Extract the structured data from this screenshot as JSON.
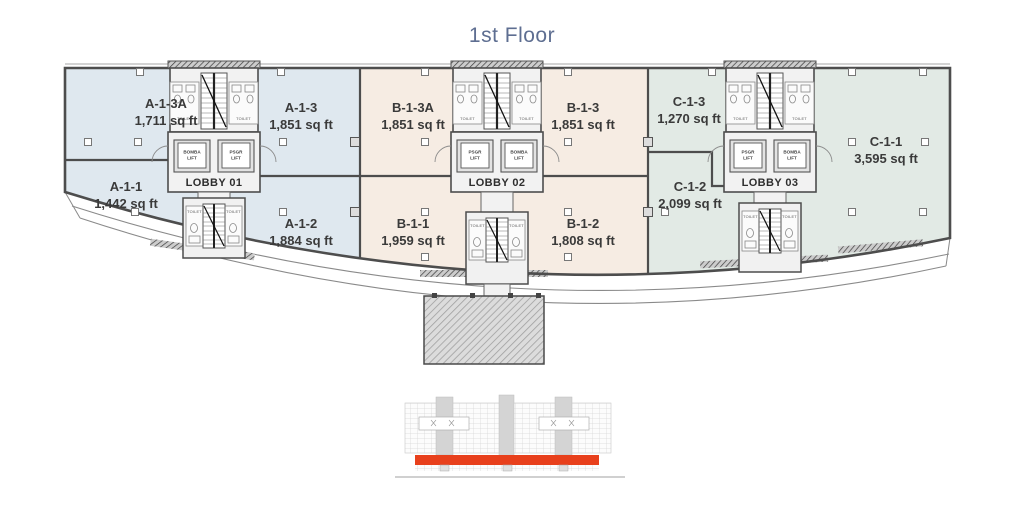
{
  "title": "1st Floor",
  "plan": {
    "units": [
      {
        "id": "A-1-3A",
        "area": "1,711 sq ft"
      },
      {
        "id": "A-1-3",
        "area": "1,851 sq ft"
      },
      {
        "id": "A-1-1",
        "area": "1,442 sq ft"
      },
      {
        "id": "A-1-2",
        "area": "1,884 sq ft"
      },
      {
        "id": "B-1-3A",
        "area": "1,851 sq ft"
      },
      {
        "id": "B-1-3",
        "area": "1,851 sq ft"
      },
      {
        "id": "B-1-1",
        "area": "1,959 sq ft"
      },
      {
        "id": "B-1-2",
        "area": "1,808 sq ft"
      },
      {
        "id": "C-1-3",
        "area": "1,270 sq ft"
      },
      {
        "id": "C-1-2",
        "area": "2,099 sq ft"
      },
      {
        "id": "C-1-1",
        "area": "3,595 sq ft"
      }
    ],
    "lobbies": [
      {
        "name": "LOBBY 01",
        "lifts": [
          {
            "line1": "BOMBA",
            "line2": "LIFT"
          },
          {
            "line1": "PSGR",
            "line2": "LIFT"
          }
        ]
      },
      {
        "name": "LOBBY 02",
        "lifts": [
          {
            "line1": "PSGR",
            "line2": "LIFT"
          },
          {
            "line1": "BOMBA",
            "line2": "LIFT"
          }
        ]
      },
      {
        "name": "LOBBY 03",
        "lifts": [
          {
            "line1": "PSGR",
            "line2": "LIFT"
          },
          {
            "line1": "BOMBA",
            "line2": "LIFT"
          }
        ]
      }
    ],
    "room_labels": {
      "toilet": "TOILET"
    }
  },
  "colors": {
    "section_a": "#dfe8ef",
    "section_b": "#f6ece3",
    "section_c": "#e2eae5",
    "wall": "#4d4d4d",
    "accent_red": "#e8401c",
    "title_blue": "#5e6e91",
    "label_dark": "#3a3a3a"
  }
}
